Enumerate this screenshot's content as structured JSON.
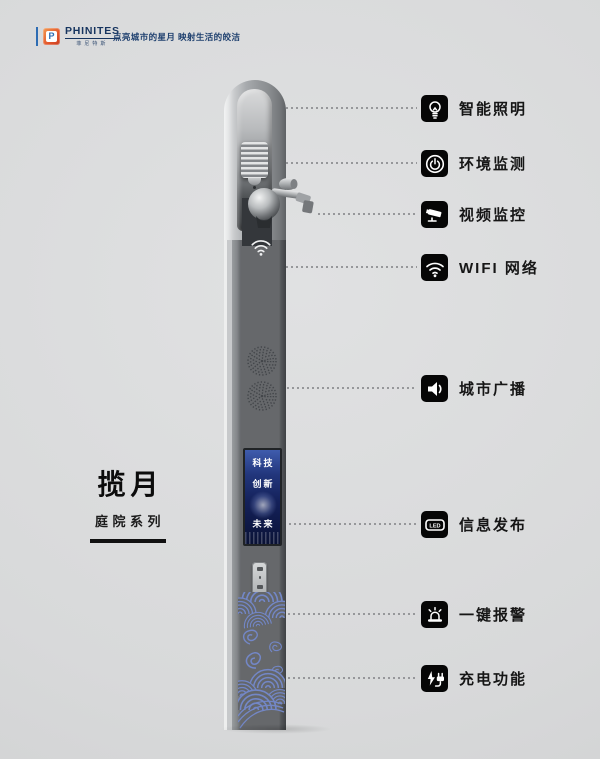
{
  "brand": {
    "name": "PHINITES",
    "sub": "菲尼特斯",
    "tagline": "点亮城市的星月 映射生活的皎洁",
    "navy": "#16345f",
    "logo_orange": "#e2562c",
    "logo_blue": "#2e6cb3",
    "logo_letter": "P"
  },
  "product": {
    "name": "揽月",
    "series": "庭院系列",
    "screen_lines": [
      "科技",
      "创新",
      "未来"
    ]
  },
  "features": [
    {
      "label": "智能照明",
      "icon": "bulb-icon"
    },
    {
      "label": "环境监测",
      "icon": "environment-icon"
    },
    {
      "label": "视频监控",
      "icon": "cctv-icon"
    },
    {
      "label": "WIFI 网络",
      "icon": "wifi-icon"
    },
    {
      "label": "城市广播",
      "icon": "speaker-icon"
    },
    {
      "label": "信息发布",
      "icon": "led-icon",
      "icon_text": "LED"
    },
    {
      "label": "一键报警",
      "icon": "alarm-icon"
    },
    {
      "label": "充电功能",
      "icon": "charging-icon"
    }
  ],
  "colors": {
    "background": "#d8d9da",
    "pole_face": "#66686b",
    "wave_blue": "#7387c7",
    "screen_blue": "#14215a",
    "icon_bg": "#060606",
    "text_dark": "#161616"
  }
}
